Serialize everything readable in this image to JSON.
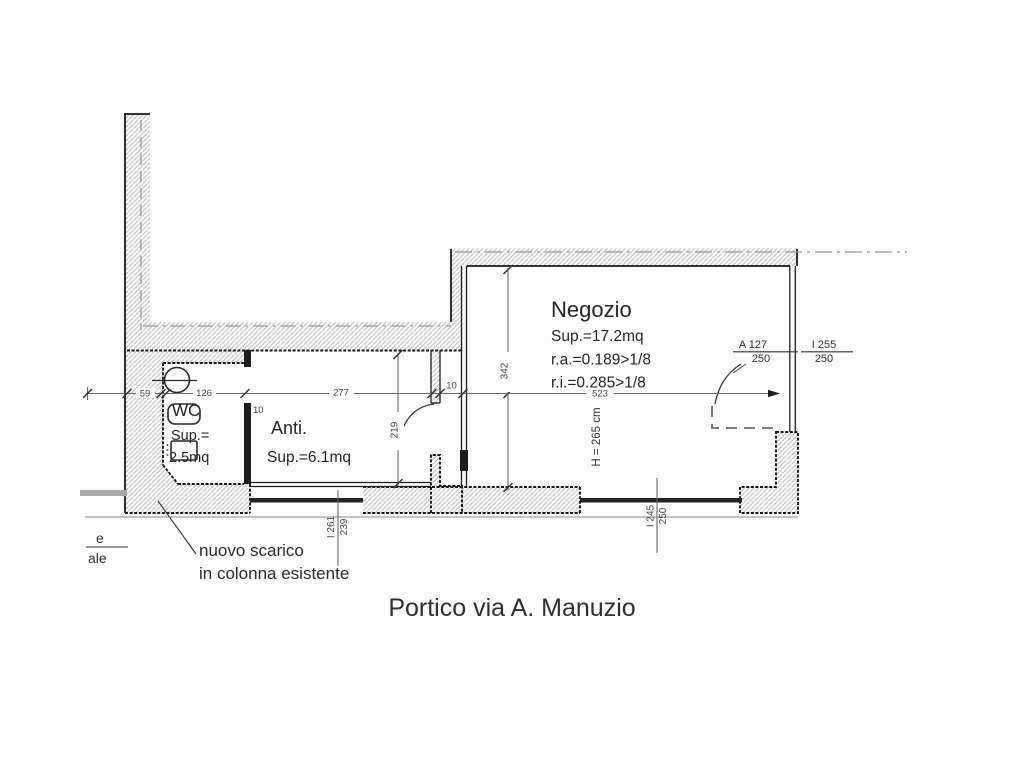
{
  "caption": "Portico via A. Manuzio",
  "colors": {
    "ink": "#1c1c1c",
    "dim_line": "#6a6a6a",
    "hatch_line": "#bdbdbd",
    "axis": "#999999",
    "background": "#fcfcfc"
  },
  "rooms": {
    "negozio": {
      "name": "Negozio",
      "sup": "Sup.=17.2mq",
      "ra": "r.a.=0.189>1/8",
      "ri": "r.i.=0.285>1/8",
      "height": "H = 265 cm"
    },
    "anti": {
      "name": "Anti.",
      "sup": "Sup.=6.1mq"
    },
    "wc": {
      "name": "WC",
      "sup_label": "Sup.=",
      "sup_value": "2.5mq"
    }
  },
  "annotations": {
    "note_line1": "nuovo scarico",
    "note_line2": "in colonna esistente",
    "edge_fragment_top": "e",
    "edge_fragment_bottom": "ale"
  },
  "dimensions": {
    "d59": "59",
    "d126": "126",
    "d277": "277",
    "d10_door": "10",
    "d10_wc": "10",
    "d523": "523",
    "d342": "342",
    "d219": "219",
    "door_a_width": "A 127",
    "door_a_height": "250",
    "door_i_width": "I 255",
    "door_i_height": "250",
    "left_pair_top": "I 261",
    "left_pair_bottom": "239",
    "bottom_pair_top": "I 245",
    "bottom_pair_bottom": "250"
  }
}
